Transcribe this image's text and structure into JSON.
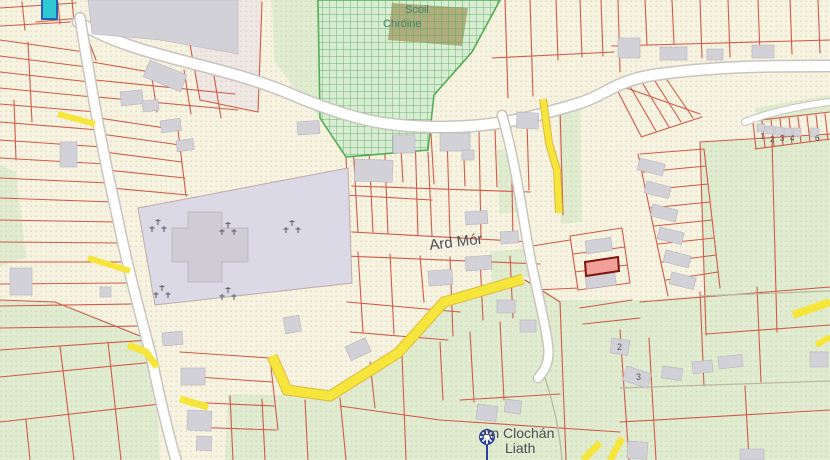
{
  "map": {
    "labels": {
      "school_line1": "Scoil",
      "school_line2": "Chróine",
      "street": "Ard Mór",
      "town_line1": "An Clochán",
      "town_line2": "Liath"
    },
    "plot_row_numbers": [
      "1",
      "2",
      "3",
      "4",
      "6"
    ],
    "building_numbers": [
      "2",
      "3"
    ],
    "colors": {
      "background": "#f7f3e1",
      "field_green": "#e0ecd0",
      "parcel_line": "#cf5a49",
      "building_fill": "#d3d1d8",
      "graveyard_fill": "#dcd9e6",
      "school_grid_green": "#54ad54",
      "road_yellow": "#f6e53a",
      "highlight_parcel_fill": "#f0a098",
      "highlight_parcel_border": "#7e150d",
      "selection_marker_fill": "#2fc9d6",
      "town_marker_blue": "#2b3f9e",
      "label_color": "#4c4c58",
      "school_label_color": "#3f8468"
    }
  }
}
